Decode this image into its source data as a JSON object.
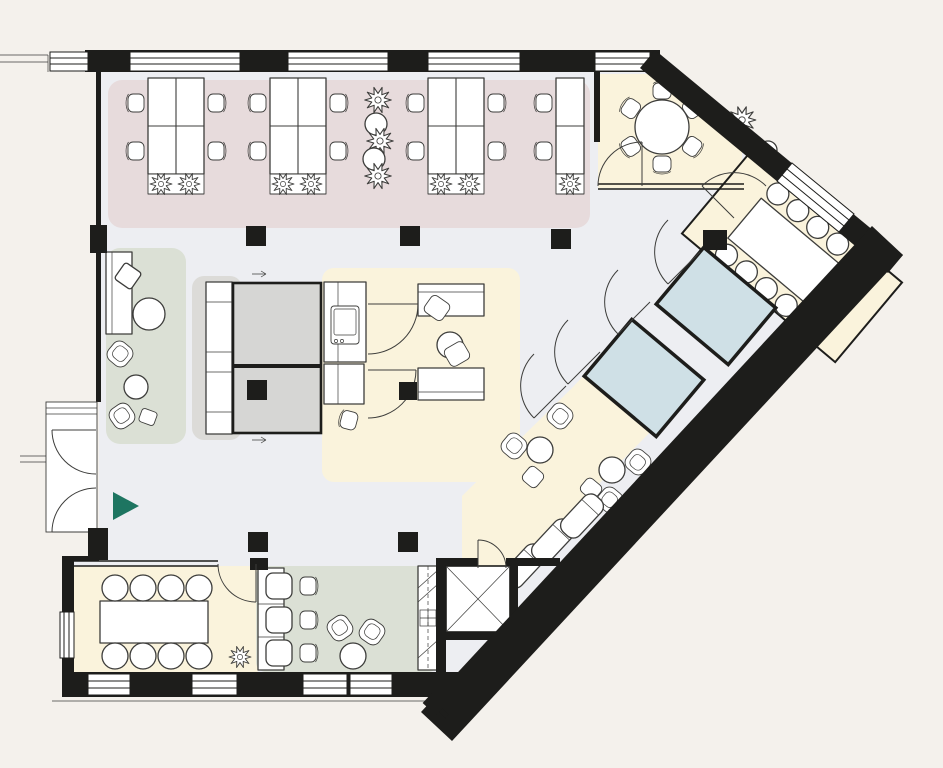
{
  "palette": {
    "canvas": "#f4f1ec",
    "floor": "#edeef2",
    "wall": "#1d1d1b",
    "line": "#3d3d3b",
    "furniture": "#ffffff",
    "zone_open_office": "#e7dbdc",
    "zone_meeting": "#faf3dc",
    "zone_lounge": "#dbe0d5",
    "zone_sanitary": "#cfe0e6",
    "zone_core": "#d6d6d4",
    "zone_storage_pad": "#dcdbd8",
    "entrance_marker": "#1e7561"
  },
  "areas": [
    {
      "id": "open-office-north",
      "zone": "zone_open_office",
      "desks": 14,
      "task_chairs": 14,
      "plants": 10
    },
    {
      "id": "focus-room-round-table",
      "zone": "zone_meeting",
      "seats": 6,
      "plants": 2
    },
    {
      "id": "conference-room-east",
      "zone": "zone_meeting",
      "seats": 10
    },
    {
      "id": "sanitary-rooms",
      "zone": "zone_sanitary",
      "rooms": 2
    },
    {
      "id": "lounge-strip-southeast",
      "zone": "zone_meeting",
      "loungers": 3,
      "armchairs": 4,
      "side_tables": 2
    },
    {
      "id": "lounge-west",
      "zone": "zone_lounge",
      "sofas": 1,
      "armchairs": 2,
      "coffee_tables": 2
    },
    {
      "id": "kitchen-hub-center",
      "zone": "zone_meeting",
      "desks": 2,
      "counters": 2,
      "sinks": 1
    },
    {
      "id": "storage-wall",
      "zone": "zone_storage_pad",
      "cabinets": 1
    },
    {
      "id": "core-rooms-center",
      "zone": "zone_core",
      "rooms": 2
    },
    {
      "id": "meeting-room-south",
      "zone": "zone_meeting",
      "seats": 8,
      "plants": 1
    },
    {
      "id": "cafe-south",
      "zone": "zone_lounge",
      "booth_tables": 3,
      "chairs": 3,
      "armchairs": 2
    },
    {
      "id": "elevator-core-south",
      "zone": "zone_core",
      "elevators": 1
    }
  ],
  "entrance": {
    "side": "west",
    "direction": "east"
  }
}
